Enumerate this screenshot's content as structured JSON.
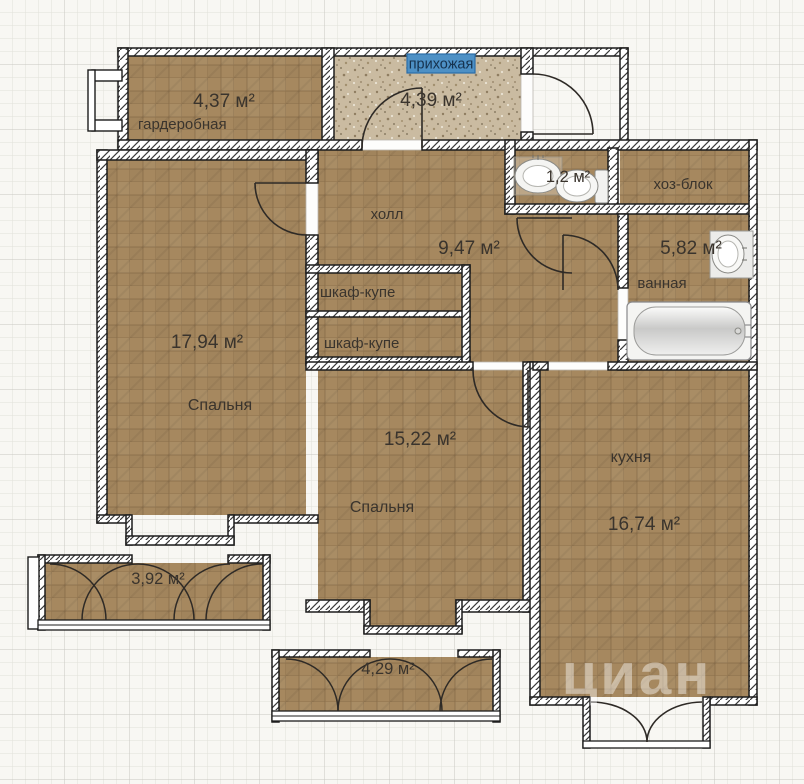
{
  "plan": {
    "labels": {
      "wardrobe_area": "4,37 м²",
      "wardrobe_name": "гардеробная",
      "entry_name": "прихожая",
      "entry_area": "4,39 м²",
      "wc_area": "1,2 м²",
      "utility_name": "хоз-блок",
      "bath_area": "5,82 м²",
      "bath_name": "ванная",
      "hall_name": "холл",
      "hall_area": "9,47 м²",
      "closet1_name": "шкаф-купе",
      "closet2_name": "шкаф-купе",
      "bedroom1_area": "17,94 м²",
      "bedroom1_name": "Спальня",
      "bedroom2_area": "15,22 м²",
      "bedroom2_name": "Спальня",
      "kitchen_name": "кухня",
      "kitchen_area": "16,74 м²",
      "balcony1_area": "3,92 м²",
      "balcony2_area": "4,29 м²",
      "watermark": "циан"
    },
    "colors": {
      "room_fill": "#a6885f",
      "entry_fill": "#cabba1",
      "highlight_bg": "#4d90c5",
      "highlight_border": "#2b6da8",
      "grid_bg": "#f8f7f3",
      "grid_minor": "#e0dfda",
      "grid_major": "#c8c7c1",
      "wall_stroke": "#1c1c1c",
      "text": "#3a342d"
    }
  }
}
